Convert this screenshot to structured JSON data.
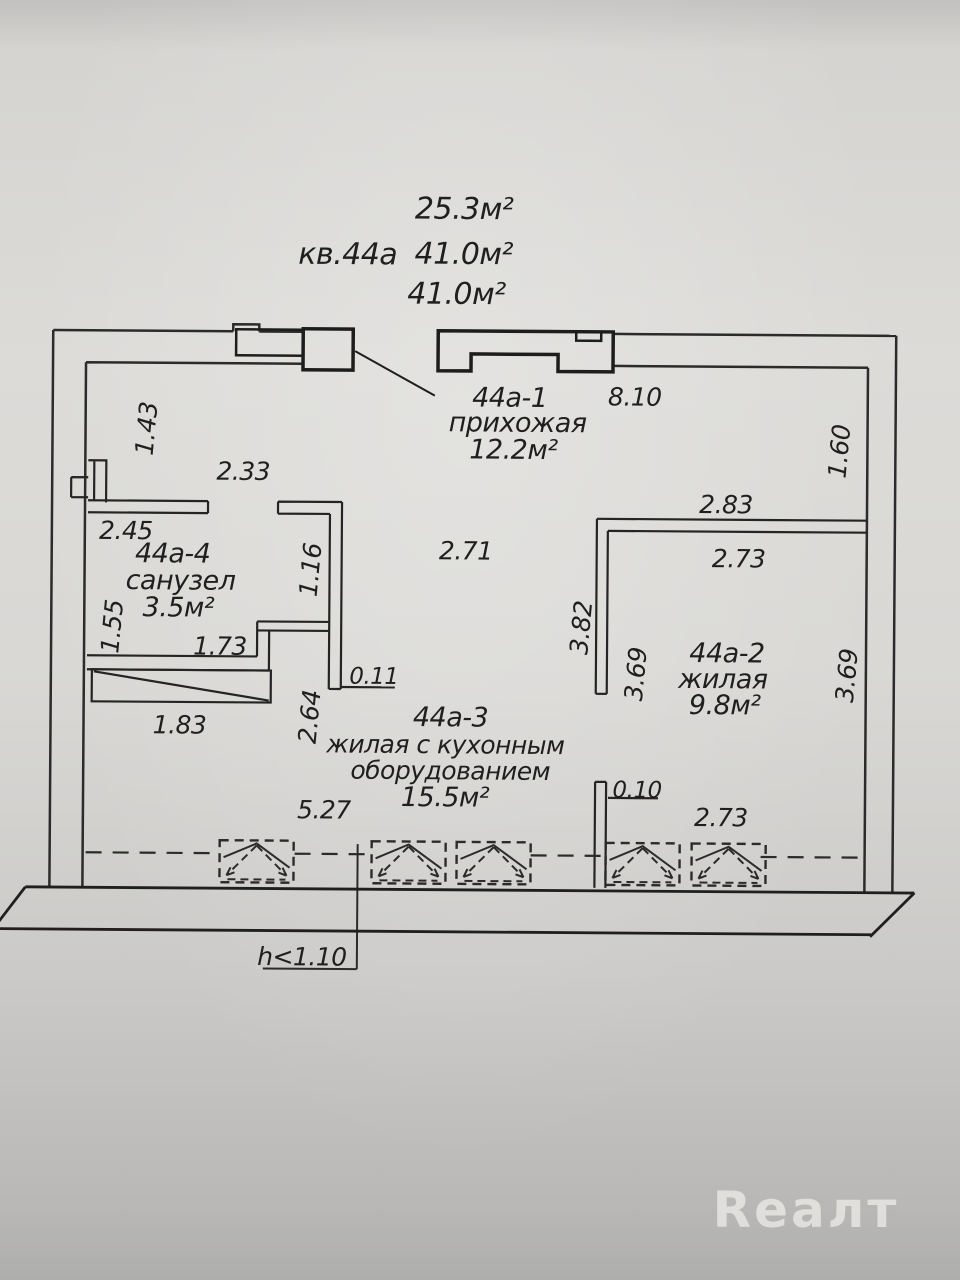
{
  "header": {
    "area_note_1": "25.3м²",
    "apartment": "кв.44а",
    "area_note_2": "41.0м²",
    "area_note_3": "41.0м²"
  },
  "rooms": {
    "hallway": {
      "id": "44а-1",
      "name": "прихожая",
      "area": "12.2м²"
    },
    "living2": {
      "id": "44а-2",
      "name": "жилая",
      "area": "9.8м²"
    },
    "kitchen_living": {
      "id": "44а-3",
      "name_line1": "жилая с кухонным",
      "name_line2": "оборудованием",
      "area": "15.5м²"
    },
    "bathroom": {
      "id": "44а-4",
      "name": "санузел",
      "area": "3.5м²"
    }
  },
  "dims": {
    "top_total": "8.10",
    "hall_left_v": "1.43",
    "hall_top_w": "2.33",
    "bath_top": "2.45",
    "bath_left": "1.55",
    "bath_bottom": "1.73",
    "bath_right": "1.16",
    "hall_width": "2.71",
    "wall_stub": "0.11",
    "kitchen_left": "2.64",
    "niche_width": "1.83",
    "kitchen_width": "5.27",
    "right_upper": "1.60",
    "room2_top_out": "2.83",
    "room2_top_in": "2.73",
    "room2_left_out": "3.82",
    "room2_left_in": "3.69",
    "room2_right": "3.69",
    "room2_stub": "0.10",
    "room2_bottom": "2.73"
  },
  "notes": {
    "parapet_height": "h<1.10"
  },
  "watermark": "Reaлт",
  "colors": {
    "line": "#2b2b2b",
    "paper": "#d9d8d5"
  }
}
